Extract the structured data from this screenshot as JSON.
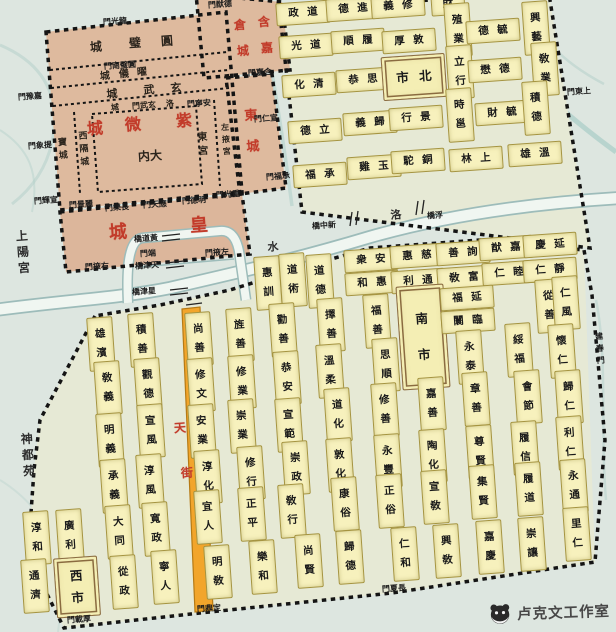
{
  "title": "隋唐洛陽城里坊圖",
  "watermark": {
    "text": "卢克文工作室"
  },
  "colors": {
    "paper": "#dde6e0",
    "city_bg": "#e6e9d5",
    "ward_fill": "#f7f1bd",
    "palace_fill": "#deba9e",
    "wall": "#141414",
    "street": "#f2a52b",
    "red": "#c23b2a",
    "river": "#9dbcba",
    "market_border": "#8a6b40"
  },
  "cells": [
    {
      "t": "政道",
      "x": 303,
      "y": 13
    },
    {
      "t": "德進",
      "x": 353,
      "y": 9
    },
    {
      "t": "義修",
      "x": 398,
      "y": 6
    },
    {
      "t": "財",
      "x": 448,
      "y": 4
    },
    {
      "t": "光道",
      "x": 306,
      "y": 46
    },
    {
      "t": "順履",
      "x": 358,
      "y": 41
    },
    {
      "t": "厚敦",
      "x": 409,
      "y": 41
    },
    {
      "t": "殖業",
      "x": 458,
      "y": 30,
      "o": "v"
    },
    {
      "t": "德毓",
      "x": 493,
      "y": 31
    },
    {
      "t": "興藝",
      "x": 536,
      "y": 28,
      "o": "v"
    },
    {
      "t": "化清",
      "x": 309,
      "y": 85
    },
    {
      "t": "恭思",
      "x": 363,
      "y": 80
    },
    {
      "t": "市北",
      "x": 414,
      "y": 77,
      "box": 1,
      "w": 56,
      "h": 42
    },
    {
      "t": "立行",
      "x": 460,
      "y": 72,
      "o": "v"
    },
    {
      "t": "懋德",
      "x": 495,
      "y": 70
    },
    {
      "t": "敎業",
      "x": 545,
      "y": 69,
      "o": "v"
    },
    {
      "t": "德立",
      "x": 315,
      "y": 131
    },
    {
      "t": "義歸",
      "x": 370,
      "y": 123
    },
    {
      "t": "行景",
      "x": 416,
      "y": 118
    },
    {
      "t": "時邕",
      "x": 460,
      "y": 115,
      "o": "v"
    },
    {
      "t": "財毓",
      "x": 502,
      "y": 113
    },
    {
      "t": "積德",
      "x": 536,
      "y": 108,
      "o": "v"
    },
    {
      "t": "福承",
      "x": 320,
      "y": 175
    },
    {
      "t": "雞玉",
      "x": 374,
      "y": 167
    },
    {
      "t": "駝銅",
      "x": 418,
      "y": 161
    },
    {
      "t": "林上",
      "x": 476,
      "y": 159
    },
    {
      "t": "雄溫",
      "x": 535,
      "y": 154
    },
    {
      "t": "雄濱",
      "x": 101,
      "y": 344,
      "o": "v"
    },
    {
      "t": "積善",
      "x": 142,
      "y": 340,
      "o": "v"
    },
    {
      "t": "敎義",
      "x": 108,
      "y": 388,
      "o": "v"
    },
    {
      "t": "觀德",
      "x": 148,
      "y": 385,
      "o": "v"
    },
    {
      "t": "明義",
      "x": 110,
      "y": 440,
      "o": "v"
    },
    {
      "t": "宣風",
      "x": 151,
      "y": 431,
      "o": "v"
    },
    {
      "t": "承義",
      "x": 114,
      "y": 486,
      "o": "v"
    },
    {
      "t": "淳風",
      "x": 150,
      "y": 481,
      "o": "v"
    },
    {
      "t": "淳和",
      "x": 37,
      "y": 538,
      "o": "v"
    },
    {
      "t": "廣利",
      "x": 70,
      "y": 536,
      "o": "v"
    },
    {
      "t": "大同",
      "x": 119,
      "y": 532,
      "o": "v"
    },
    {
      "t": "寬政",
      "x": 156,
      "y": 529,
      "o": "v"
    },
    {
      "t": "通濟",
      "x": 35,
      "y": 586,
      "o": "v"
    },
    {
      "t": "西市",
      "x": 77,
      "y": 587,
      "o": "v",
      "box": 1,
      "w": 42,
      "h": 52
    },
    {
      "t": "從政",
      "x": 124,
      "y": 582,
      "o": "v"
    },
    {
      "t": "寧人",
      "x": 165,
      "y": 577,
      "o": "v"
    },
    {
      "t": "惠訓",
      "x": 268,
      "y": 283,
      "o": "v"
    },
    {
      "t": "道術",
      "x": 293,
      "y": 280,
      "o": "v"
    },
    {
      "t": "道德",
      "x": 320,
      "y": 281,
      "o": "v"
    },
    {
      "t": "衆安",
      "x": 371,
      "y": 260
    },
    {
      "t": "和惠",
      "x": 372,
      "y": 283
    },
    {
      "t": "惠慈",
      "x": 417,
      "y": 256
    },
    {
      "t": "利通",
      "x": 418,
      "y": 281
    },
    {
      "t": "善詢",
      "x": 463,
      "y": 253
    },
    {
      "t": "敎富",
      "x": 464,
      "y": 278
    },
    {
      "t": "猷嘉",
      "x": 506,
      "y": 248
    },
    {
      "t": "仁睦",
      "x": 509,
      "y": 273
    },
    {
      "t": "慶延",
      "x": 550,
      "y": 245
    },
    {
      "t": "仁靜",
      "x": 550,
      "y": 270
    },
    {
      "t": "尚善",
      "x": 199,
      "y": 339,
      "o": "v"
    },
    {
      "t": "旌善",
      "x": 240,
      "y": 335,
      "o": "v"
    },
    {
      "t": "勸善",
      "x": 283,
      "y": 330,
      "o": "v"
    },
    {
      "t": "擇善",
      "x": 331,
      "y": 325,
      "o": "v"
    },
    {
      "t": "福善",
      "x": 377,
      "y": 321,
      "o": "v"
    },
    {
      "t": "南市",
      "x": 423,
      "y": 337,
      "o": "v",
      "box": 1,
      "w": 46,
      "h": 96
    },
    {
      "t": "福延",
      "x": 467,
      "y": 298
    },
    {
      "t": "闤臨",
      "x": 468,
      "y": 321
    },
    {
      "t": "從善",
      "x": 549,
      "y": 306,
      "o": "v"
    },
    {
      "t": "仁風",
      "x": 566,
      "y": 303,
      "o": "v"
    },
    {
      "t": "修文",
      "x": 201,
      "y": 385,
      "o": "v"
    },
    {
      "t": "修業",
      "x": 242,
      "y": 382,
      "o": "v"
    },
    {
      "t": "恭安",
      "x": 287,
      "y": 378,
      "o": "v"
    },
    {
      "t": "溫柔",
      "x": 330,
      "y": 371,
      "o": "v"
    },
    {
      "t": "思順",
      "x": 386,
      "y": 365,
      "o": "v"
    },
    {
      "t": "永泰",
      "x": 470,
      "y": 357,
      "o": "v"
    },
    {
      "t": "綏福",
      "x": 519,
      "y": 350,
      "o": "v"
    },
    {
      "t": "懷仁",
      "x": 562,
      "y": 351,
      "o": "v"
    },
    {
      "t": "安業",
      "x": 202,
      "y": 431,
      "o": "v"
    },
    {
      "t": "崇業",
      "x": 242,
      "y": 426,
      "o": "v"
    },
    {
      "t": "宣範",
      "x": 289,
      "y": 425,
      "o": "v"
    },
    {
      "t": "道化",
      "x": 338,
      "y": 415,
      "o": "v"
    },
    {
      "t": "修善",
      "x": 385,
      "y": 410,
      "o": "v"
    },
    {
      "t": "嘉善",
      "x": 432,
      "y": 404,
      "o": "v"
    },
    {
      "t": "章善",
      "x": 476,
      "y": 399,
      "o": "v"
    },
    {
      "t": "會節",
      "x": 528,
      "y": 397,
      "o": "v"
    },
    {
      "t": "歸仁",
      "x": 569,
      "y": 397,
      "o": "v"
    },
    {
      "t": "淳化",
      "x": 208,
      "y": 477,
      "o": "v"
    },
    {
      "t": "修行",
      "x": 251,
      "y": 473,
      "o": "v"
    },
    {
      "t": "崇政",
      "x": 296,
      "y": 468,
      "o": "v"
    },
    {
      "t": "敦化",
      "x": 340,
      "y": 465,
      "o": "v"
    },
    {
      "t": "永豐",
      "x": 388,
      "y": 461,
      "o": "v"
    },
    {
      "t": "陶化",
      "x": 433,
      "y": 456,
      "o": "v"
    },
    {
      "t": "尊賢",
      "x": 480,
      "y": 452,
      "o": "v"
    },
    {
      "t": "履信",
      "x": 525,
      "y": 448,
      "o": "v"
    },
    {
      "t": "利仁",
      "x": 570,
      "y": 443,
      "o": "v"
    },
    {
      "t": "宜人",
      "x": 208,
      "y": 517,
      "o": "v"
    },
    {
      "t": "正平",
      "x": 252,
      "y": 514,
      "o": "v"
    },
    {
      "t": "敎行",
      "x": 292,
      "y": 511,
      "o": "v"
    },
    {
      "t": "康俗",
      "x": 345,
      "y": 504,
      "o": "v"
    },
    {
      "t": "正俗",
      "x": 390,
      "y": 501,
      "o": "v"
    },
    {
      "t": "宣敎",
      "x": 435,
      "y": 497,
      "o": "v"
    },
    {
      "t": "集賢",
      "x": 483,
      "y": 492,
      "o": "v"
    },
    {
      "t": "履道",
      "x": 529,
      "y": 489,
      "o": "v"
    },
    {
      "t": "永通",
      "x": 574,
      "y": 486,
      "o": "v"
    },
    {
      "t": "明敎",
      "x": 218,
      "y": 572,
      "o": "v"
    },
    {
      "t": "樂和",
      "x": 263,
      "y": 567,
      "o": "v"
    },
    {
      "t": "尚賢",
      "x": 309,
      "y": 561,
      "o": "v"
    },
    {
      "t": "歸德",
      "x": 350,
      "y": 557,
      "o": "v"
    },
    {
      "t": "仁和",
      "x": 405,
      "y": 554,
      "o": "v"
    },
    {
      "t": "興敎",
      "x": 447,
      "y": 551,
      "o": "v"
    },
    {
      "t": "嘉慶",
      "x": 490,
      "y": 547,
      "o": "v"
    },
    {
      "t": "崇讓",
      "x": 532,
      "y": 544,
      "o": "v"
    },
    {
      "t": "里仁",
      "x": 577,
      "y": 534,
      "o": "v"
    }
  ],
  "labels": [
    {
      "t": "紫",
      "x": 184,
      "y": 121,
      "cls": "red",
      "fs": 16
    },
    {
      "t": "微",
      "x": 133,
      "y": 125,
      "cls": "red",
      "fs": 16
    },
    {
      "t": "城",
      "x": 95,
      "y": 129,
      "cls": "red",
      "fs": 16
    },
    {
      "t": "皇",
      "x": 199,
      "y": 226,
      "cls": "red",
      "fs": 18
    },
    {
      "t": "城",
      "x": 118,
      "y": 233,
      "cls": "red",
      "fs": 18
    },
    {
      "t": "含",
      "x": 264,
      "y": 22,
      "cls": "red",
      "fs": 12
    },
    {
      "t": "倉",
      "x": 240,
      "y": 25,
      "cls": "red",
      "fs": 12
    },
    {
      "t": "嘉",
      "x": 267,
      "y": 48,
      "cls": "red",
      "fs": 12
    },
    {
      "t": "城",
      "x": 243,
      "y": 51,
      "cls": "red",
      "fs": 12
    },
    {
      "t": "東",
      "x": 251,
      "y": 116,
      "cls": "red",
      "fs": 13
    },
    {
      "t": "城",
      "x": 253,
      "y": 147,
      "cls": "red",
      "fs": 13
    },
    {
      "t": "天",
      "x": 180,
      "y": 428,
      "cls": "red",
      "fs": 12
    },
    {
      "t": "街",
      "x": 187,
      "y": 473,
      "cls": "red",
      "fs": 12
    },
    {
      "t": "城",
      "x": 96,
      "y": 47,
      "cls": "pal",
      "fs": 12
    },
    {
      "t": "璧",
      "x": 135,
      "y": 43,
      "cls": "pal",
      "fs": 12
    },
    {
      "t": "圓",
      "x": 167,
      "y": 41,
      "cls": "pal",
      "fs": 12
    },
    {
      "t": "城",
      "x": 105,
      "y": 77,
      "cls": "pal",
      "fs": 10
    },
    {
      "t": "儀",
      "x": 124,
      "y": 75,
      "cls": "pal",
      "fs": 10
    },
    {
      "t": "曜",
      "x": 142,
      "y": 73,
      "cls": "pal",
      "fs": 10
    },
    {
      "t": "城",
      "x": 112,
      "y": 94,
      "cls": "pal",
      "fs": 11
    },
    {
      "t": "武",
      "x": 149,
      "y": 90,
      "cls": "pal",
      "fs": 11
    },
    {
      "t": "玄",
      "x": 176,
      "y": 88,
      "cls": "pal",
      "fs": 11
    },
    {
      "t": "城",
      "x": 115,
      "y": 108,
      "cls": "pal",
      "fs": 8
    },
    {
      "t": "門武玄",
      "x": 144,
      "y": 106,
      "cls": "pal",
      "fs": 8
    },
    {
      "t": "洛",
      "x": 170,
      "y": 104,
      "cls": "pal",
      "fs": 8
    },
    {
      "t": "内大",
      "x": 150,
      "y": 156,
      "cls": "pal",
      "fs": 12
    },
    {
      "t": "西隔城",
      "x": 84,
      "y": 150,
      "cls": "pal",
      "fs": 9,
      "v": 1
    },
    {
      "t": "寶城",
      "x": 63,
      "y": 150,
      "cls": "pal",
      "fs": 9,
      "v": 1
    },
    {
      "t": "東宮",
      "x": 203,
      "y": 145,
      "cls": "pal",
      "fs": 10,
      "v": 1
    },
    {
      "t": "左掖宮",
      "x": 226,
      "y": 140,
      "cls": "pal",
      "fs": 8,
      "v": 1
    },
    {
      "t": "上陽宮",
      "x": 23,
      "y": 252,
      "cls": "plc",
      "fs": 12,
      "v": 1
    },
    {
      "t": "神都苑",
      "x": 28,
      "y": 455,
      "cls": "plc",
      "fs": 12,
      "v": 1
    },
    {
      "t": "洛",
      "x": 396,
      "y": 215,
      "cls": "plc",
      "fs": 11
    },
    {
      "t": "水",
      "x": 273,
      "y": 247,
      "cls": "plc",
      "fs": 11
    },
    {
      "t": "橋道黃",
      "x": 146,
      "y": 239,
      "cls": "gate",
      "fs": 8
    },
    {
      "t": "橋津天",
      "x": 147,
      "y": 266,
      "cls": "gate",
      "fs": 8
    },
    {
      "t": "橋津星",
      "x": 144,
      "y": 292,
      "cls": "gate",
      "fs": 8
    },
    {
      "t": "橋中新",
      "x": 324,
      "y": 226,
      "cls": "gate",
      "fs": 8
    },
    {
      "t": "橋浮",
      "x": 435,
      "y": 216,
      "cls": "gate",
      "fs": 8
    }
  ],
  "gates": [
    {
      "t": "門光龍",
      "x": 115,
      "y": 22
    },
    {
      "t": "門猷德",
      "x": 220,
      "y": 5
    },
    {
      "t": "門南璧圓",
      "x": 120,
      "y": 66
    },
    {
      "t": "門嘉含",
      "x": 260,
      "y": 73
    },
    {
      "t": "門豫嘉",
      "x": 30,
      "y": 97
    },
    {
      "t": "門寧安",
      "x": 199,
      "y": 104
    },
    {
      "t": "門東上",
      "x": 579,
      "y": 92
    },
    {
      "t": "門仁宣",
      "x": 266,
      "y": 119
    },
    {
      "t": "門象提",
      "x": 40,
      "y": 146
    },
    {
      "t": "門福承",
      "x": 278,
      "y": 177
    },
    {
      "t": "門輝宣",
      "x": 46,
      "y": 201
    },
    {
      "t": "門景麗",
      "x": 81,
      "y": 205
    },
    {
      "t": "門樂長",
      "x": 117,
      "y": 208
    },
    {
      "t": "門天應",
      "x": 155,
      "y": 205
    },
    {
      "t": "門德明",
      "x": 194,
      "y": 201
    },
    {
      "t": "門光重",
      "x": 228,
      "y": 195
    },
    {
      "t": "門掖右",
      "x": 97,
      "y": 267
    },
    {
      "t": "門端",
      "x": 148,
      "y": 254
    },
    {
      "t": "門掖左",
      "x": 217,
      "y": 253
    },
    {
      "t": "建春門",
      "x": 600,
      "y": 349,
      "v": 1
    },
    {
      "t": "門夏長",
      "x": 394,
      "y": 589
    },
    {
      "t": "門鼎定",
      "x": 209,
      "y": 609
    },
    {
      "t": "門載厚",
      "x": 79,
      "y": 620
    }
  ]
}
